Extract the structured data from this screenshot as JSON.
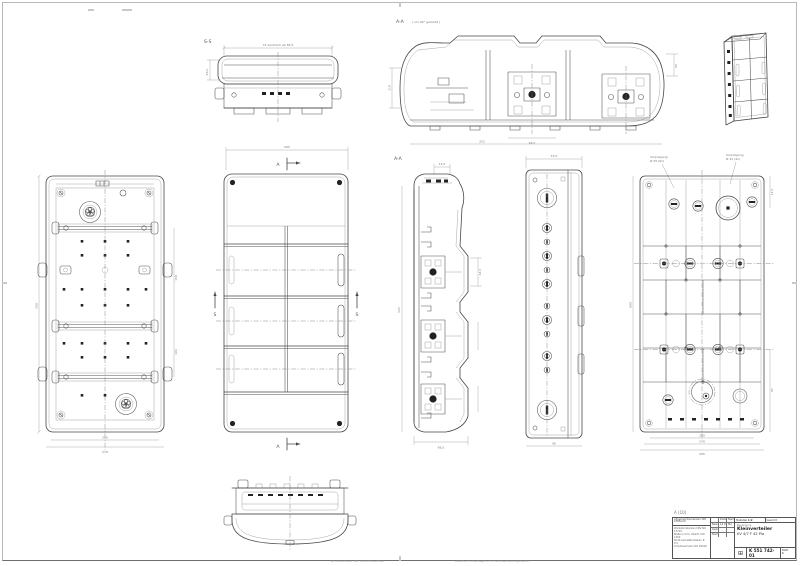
{
  "sheet": {
    "zone_label": "A (10)",
    "footer_left": "Schutzvermerk ISO 16016 beachten",
    "footer_right": "Ausdruck unterliegt nicht dem Aenderungsdienst"
  },
  "views": {
    "end_top": {
      "label": "S-S",
      "dim_top": "74 zentrisch ab 82,5",
      "dim_left": "46,5"
    },
    "section_rot": {
      "label": "A-A",
      "note": "( um 90° gedreht )",
      "dim_left": "110",
      "dim_right": "62",
      "dim_b1": "44,5",
      "dim_b2": "252"
    },
    "iso": {
      "label": ""
    },
    "interior": {
      "dim_left": "560",
      "dim_r1": "150",
      "dim_r2": "104",
      "dim_b1": "250",
      "dim_b2": "276"
    },
    "front": {
      "dim_top": "295",
      "sec_a_top": "A",
      "sec_a_bottom": "A",
      "sec_s_left": "S",
      "sec_s_right": "S"
    },
    "section_vert": {
      "label": "A-A",
      "dim_top": "14,5",
      "dim_side": "44,5",
      "dim_bottom": "86,5",
      "dim_left": "525"
    },
    "side": {
      "dim_top": "53,5",
      "dim_bottom": "96"
    },
    "rear": {
      "note_l1": "Vorprägung",
      "note_l2": "Ø 25 (6x)",
      "note_r1": "Vorprägung",
      "note_r2": "Ø 32 (4x)",
      "dim_left": "600",
      "dim_r1": "12,5",
      "dim_r2": "65",
      "dim_b1": "250",
      "dim_b2": "276",
      "dim_b3": "295"
    }
  },
  "title_block": {
    "general_tol_header": "Allgemeintoleranzen ISO 2768-mK",
    "notes_1": "Werkstückkanten DIN ISO 13715",
    "notes_2": "Maße in mm, Oberfl. ISO 1302",
    "notes_3": "Nicht bemaßte Radien R 0,5",
    "notes_4": "Schutzvermerk ISO 16016",
    "rows_h_datum": "Datum",
    "rows_h_name": "Name",
    "row1_l": "Bearb.",
    "row1_d": "12.03.",
    "row1_n": "Mü",
    "row2_l": "Gepr.",
    "row2_d": "",
    "row2_n": "",
    "row3_l": "Norm",
    "row3_d": "",
    "row3_n": "",
    "scale_label": "Maßstab",
    "scale_value": "1:2",
    "weight_label": "Gewicht",
    "benennung_label": "Benennung",
    "title": "Kleinverteiler",
    "subtitle": "KV 4/7 F 42 Pla",
    "logo_glyph": "⊞",
    "number": "K 551 742-01",
    "sheet_label": "Blatt",
    "sheet_value": "1"
  }
}
